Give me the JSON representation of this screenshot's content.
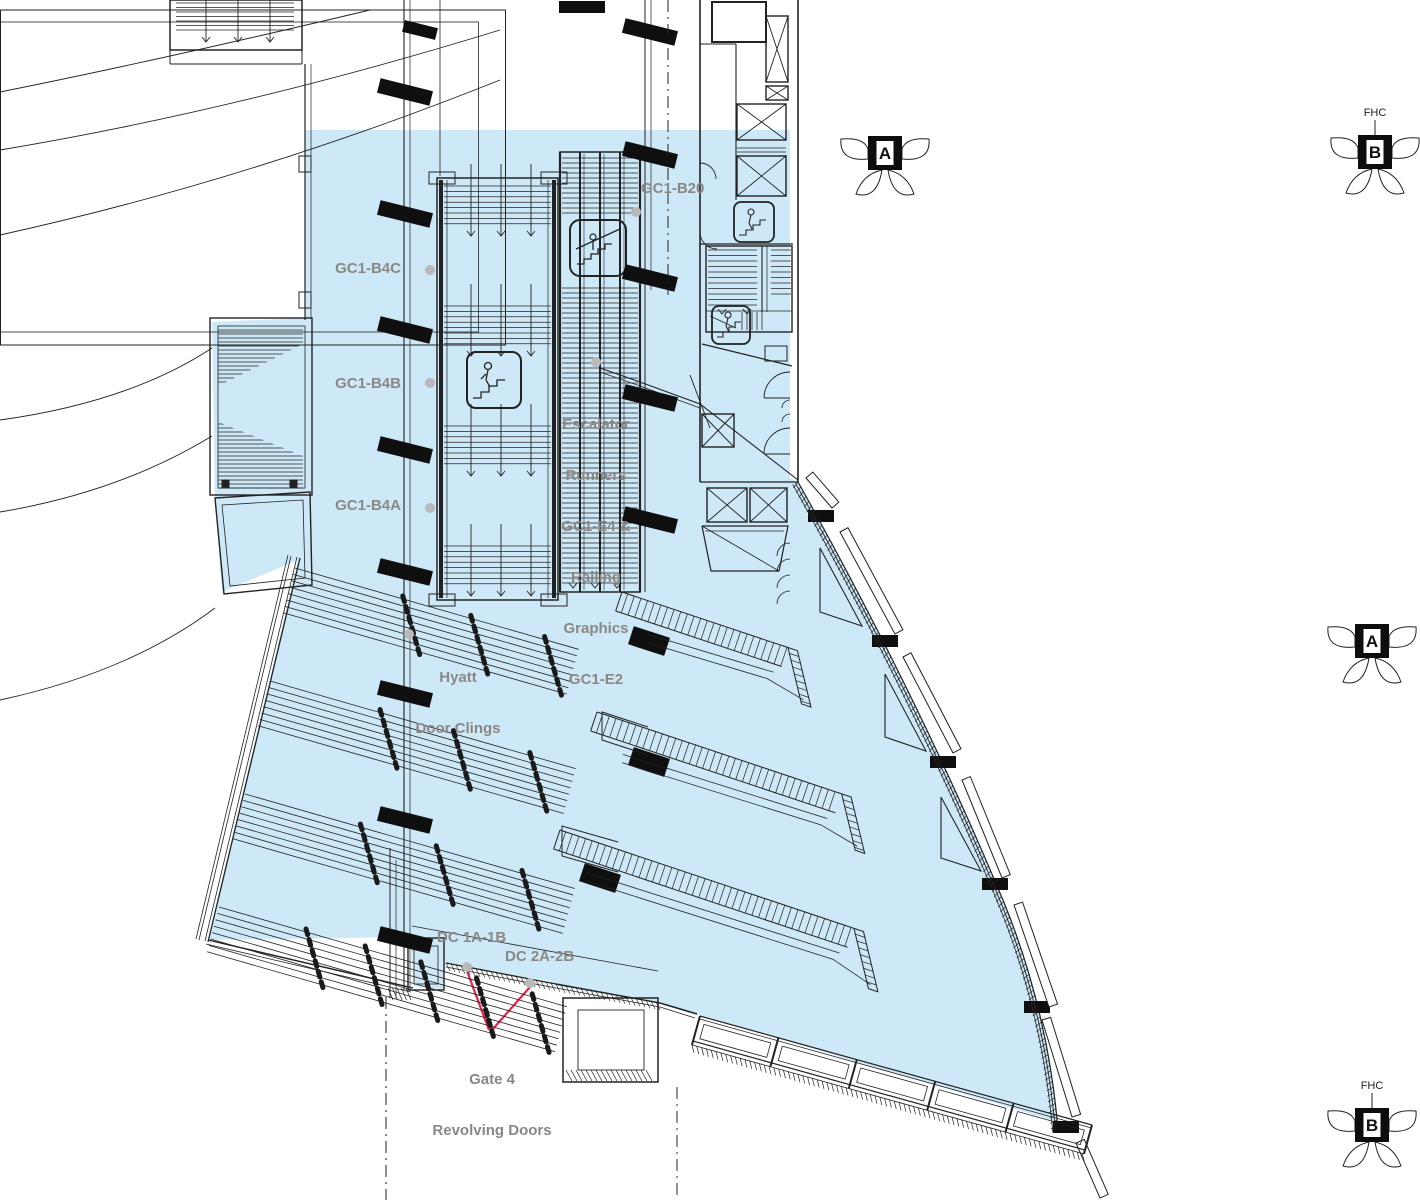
{
  "colors": {
    "highlight_fill": "#cde8f7",
    "line": "#222222",
    "label_gray": "#8b8884",
    "leader_red": "#ef2048",
    "anchor_dot": "#b9b9b9",
    "marker_black": "#0d0d0d"
  },
  "labels": {
    "gc1_b20": "GC1-B20",
    "gc1_b4c": "GC1-B4C",
    "gc1_b4b": "GC1-B4B",
    "gc1_b4a": "GC1-B4A",
    "escalator_note_lines": [
      "Escalator",
      "Runners",
      "GC1-E4 &",
      "Railing",
      "Graphics",
      "GC1-E2"
    ],
    "hyatt_note_lines": [
      "Hyatt",
      "Door Clings"
    ],
    "dc_left": "DC 1A-1B",
    "dc_right": "DC 2A-2B",
    "gate_note_lines": [
      "Gate 4",
      "Revolving Doors"
    ]
  },
  "markers": {
    "top_a": {
      "letter": "A"
    },
    "top_b": {
      "letter": "B",
      "tag": "FHC"
    },
    "mid_a": {
      "letter": "A"
    },
    "bottom_b": {
      "letter": "B",
      "tag": "FHC"
    }
  },
  "icons": {
    "escalator": "escalator-icon",
    "stairs": "stairs-icon",
    "elevator": "elevator-x-icon",
    "detail_marker": "detail-flower-icon"
  }
}
